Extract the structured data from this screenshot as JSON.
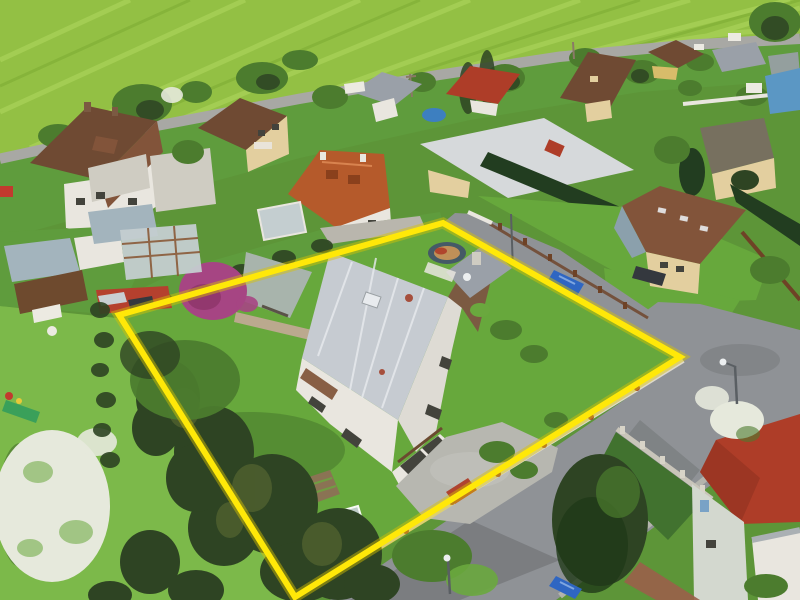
{
  "scene": {
    "description": "Aerial drone photograph of a suburban village neighborhood. A detached two-story family house with a silver corrugated gable roof, brown stair tower, garage, gravel driveway, pergola, magenta flowering tree, vegetable garden, greenhouse and a large cluster of mature conifer trees is highlighted by a thick yellow property-boundary outline. A bright green crop field with mowing stripes spans the top, a road with neighboring houses runs below it, and asphalt streets with parked blue cars, streetlamps and a red-hip-roof house occupy the lower right. A neighbor garden with sheds, a swing bench, a slide and a white blossoming tree lies to the left."
  },
  "boundary": {
    "points": "443,223 680,357 295,597 119,315",
    "stroke_width": 6,
    "glow_width": 11
  },
  "palette": {
    "base_lawn": "#5d9538",
    "field": "#93c044",
    "field_stripe_light": "#a9d258",
    "field_stripe_dark": "#7cab33",
    "road": "#8f9296",
    "road_light": "#a8a8a4",
    "sidewalk": "#b9b8b0",
    "lawn_bright": "#67a83c",
    "lawn_mid": "#5f9c3d",
    "lawn_dark": "#41722f",
    "lawn_neighbor": "#7cb94a",
    "tree_dark": "#2e4423",
    "tree_olive": "#5c6b33",
    "tree_mid": "#4c7c2e",
    "tree_light": "#6aa83e",
    "hedge": "#223d20",
    "blossom_white": "#e6e9dc",
    "magenta_tree": "#a64583",
    "magenta_dark": "#8d3569",
    "roof_brown": "#6f4a33",
    "roof_brown_light": "#82543a",
    "roof_orange": "#b55a2b",
    "roof_orange_dark": "#8a401c",
    "roof_red": "#ae3d28",
    "roof_red_dark": "#8f3220",
    "roof_silver": "#c6cbd1",
    "roof_white": "#d6d9db",
    "roof_gray": "#9aa0a8",
    "roof_dark": "#77705f",
    "roof_ridge": "#e8ebee",
    "rust": "#a03a22",
    "wall_white": "#e9e6df",
    "wall_east": "#dedbd4",
    "wall_cream": "#e3cf9f",
    "wall_yellow": "#d8bc6a",
    "wall_brown": "#7b5a42",
    "wall_blue": "#8ba0ac",
    "wall_green_white": "#d3d8cf",
    "house_blue": "#5b97c4",
    "awning_brown": "#7d5034",
    "gravel": "#b7b7b0",
    "gravel_light": "#c6c6bf",
    "paving": "#b9b6ad",
    "concrete": "#cfccc2",
    "stone": "#bba98e",
    "pergola_roof": "#a8b4ac",
    "greenhouse_glass": "#c4ced0",
    "greenhouse_frame": "#8a5a38",
    "glass_white": "#ffffff",
    "shed_metal": "#a3b4bd",
    "shed_wood": "#6e4a2e",
    "carport_red": "#b5402e",
    "fence_white": "#ded9cc",
    "fence_brown": "#6e4226",
    "fence_concrete": "#c9c5ba",
    "pillar_light": "#d8d4c8",
    "post_red": "#a34a30",
    "car_blue": "#2f66c2",
    "car_blue_hi": "#7fa6e0",
    "car_dark": "#34383e",
    "car_red": "#c23a2e",
    "car_silver": "#c9ced2",
    "van_white": "#eceae2",
    "pool_blue": "#3d7fc0",
    "tramp_ring": "#455a66",
    "tramp_pad": "#c09058",
    "window_dark": "#43433c",
    "shadow_green": "#1f3a18",
    "shadow_dark": "#101510",
    "slide_green": "#3aa05a",
    "toy_yellow": "#e8c83a",
    "brick": "#9a5f4a",
    "boundary_yellow": "#ffe808",
    "boundary_glow": "#d9c400",
    "lamp_pole": "#5a5f63",
    "lamp_white": "#eceff0",
    "pole_brown": "#8a7a66",
    "door_band": "#6b4a30"
  }
}
